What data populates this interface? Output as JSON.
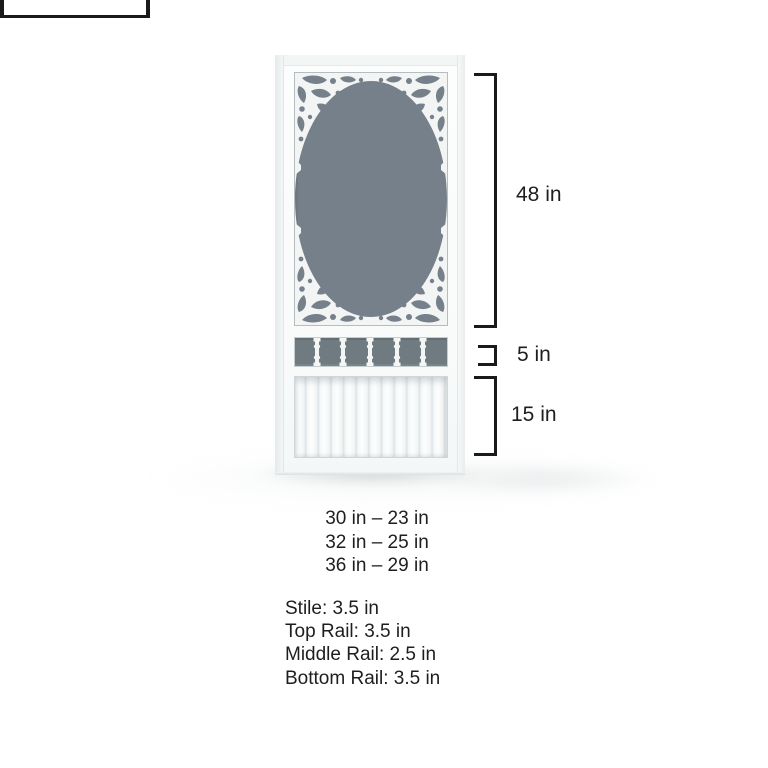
{
  "diagram": {
    "subject": "victorian-screen-door",
    "right_dimensions": [
      {
        "section": "screen-panel",
        "label": "48 in"
      },
      {
        "section": "spindle-section",
        "label": "5 in"
      },
      {
        "section": "bottom-panel",
        "label": "15 in"
      }
    ],
    "width_options": [
      "30 in – 23 in",
      "32 in – 25 in",
      "36 in – 29 in"
    ],
    "specs": [
      "Stile: 3.5 in",
      "Top Rail: 3.5 in",
      "Middle Rail: 2.5 in",
      "Bottom Rail: 3.5 in"
    ],
    "colors": {
      "screen_mesh": "#75808a",
      "spindle_band": "#6f7a81",
      "door_white": "#fbfcfc",
      "annotation": "#1a1a1a"
    }
  }
}
